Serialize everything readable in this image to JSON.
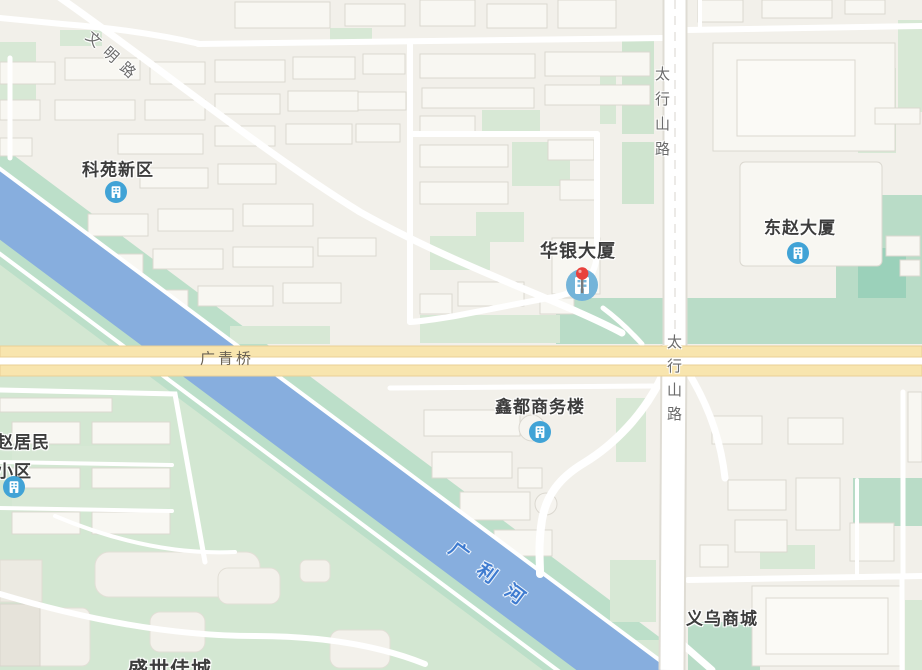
{
  "map": {
    "labels": {
      "keyuan": "科苑新区",
      "huayin": "华银大厦",
      "dongzhao": "东赵大厦",
      "xindu": "鑫都商务楼",
      "zhaojumin_line1": "赵居民",
      "zhaojumin_line2": "小区",
      "yiwu": "义乌商城",
      "shengshi": "盛世佳城",
      "wenming_road": "文明路",
      "taihangshan_road_north": "太行山路",
      "taihangshan_road_south": "太行山路",
      "guangqing_bridge": "广青桥",
      "guangli_river": "广利河"
    },
    "icons": {
      "poi_building_icon": "building-in-blue-circle",
      "selected_marker": "red-pin-on-blue-building-circle"
    },
    "colors": {
      "background": "#F2F0EA",
      "river": "#87AEDE",
      "river_label": "#3E7BD0",
      "highway_yellow": "#F8E5AE",
      "highway_border": "#EAD096",
      "green_light": "#D7E8D5",
      "green_medium": "#B9DCC7",
      "green_saturated": "#9BD1BA",
      "building_fill": "#F8F7F2",
      "building_stroke": "#DBD8D0",
      "poi_icon_blue": "#41A3D6",
      "pin_red": "#E8413C",
      "poi_text": "#3D3D3D",
      "road_text": "#6B6B6B"
    }
  }
}
